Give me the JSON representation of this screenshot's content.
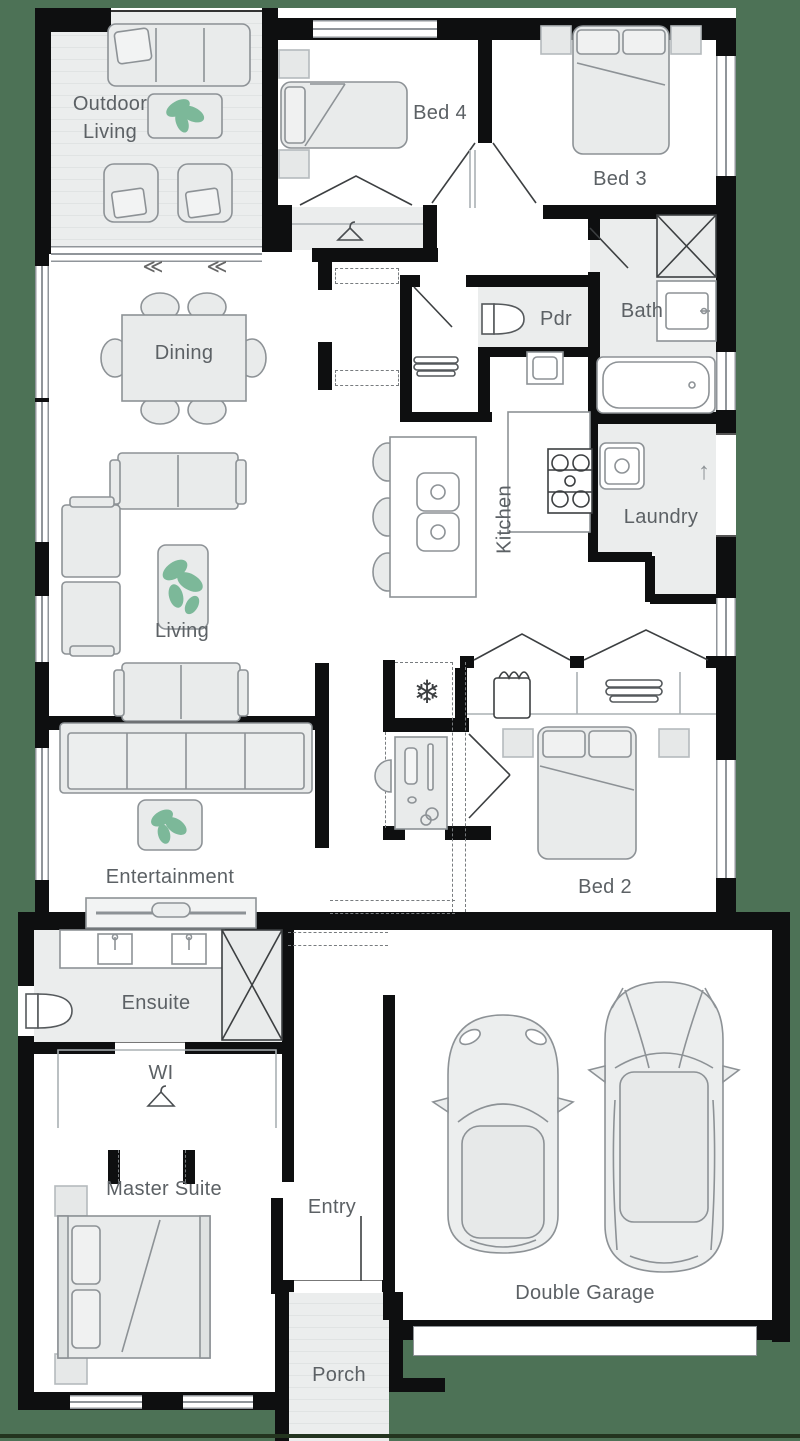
{
  "title": "Single storey home floor plan",
  "rooms": {
    "outdoor_living": "Outdoor Living",
    "bed4": "Bed 4",
    "bed3": "Bed 3",
    "pdr": "Pdr",
    "bath": "Bath",
    "dining": "Dining",
    "kitchen": "Kitchen",
    "laundry": "Laundry",
    "living": "Living",
    "entertainment": "Entertainment",
    "bed2": "Bed 2",
    "ensuite": "Ensuite",
    "wi": "WI",
    "master_suite": "Master Suite",
    "entry": "Entry",
    "porch": "Porch",
    "double_garage": "Double Garage"
  },
  "icons": {
    "snowflake": "❄",
    "slide_arrows": "≪",
    "up_arrow": "↑"
  },
  "colors": {
    "outside_green": "#4d7256",
    "wall_black": "#0e0f10",
    "floor_white": "#ffffff",
    "shaded_gray": "#ebeded",
    "furniture_stroke": "#8d9296",
    "plant_green": "#7cb899",
    "label_gray": "#5c6165"
  }
}
